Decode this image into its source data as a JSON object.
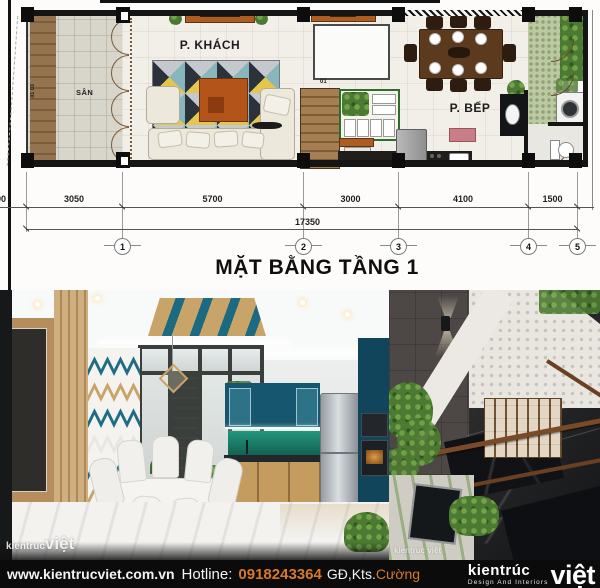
{
  "plan": {
    "title": "MẶT BẰNG TẦNG 1",
    "rooms": {
      "san": "SÂN",
      "khach": "P. KHÁCH",
      "bep": "P. BẾP"
    },
    "tags": {
      "wall_a": "01",
      "wall_b": "03",
      "stair": "01"
    },
    "dimensions": {
      "left_partial": "990",
      "segments": [
        "3050",
        "5700",
        "3000",
        "4100",
        "1500"
      ],
      "total": "17350"
    },
    "grid": [
      "1",
      "2",
      "3",
      "4",
      "5"
    ]
  },
  "footer": {
    "website": "www.kientrucviet.com.vn",
    "hotline_label": "Hotline:",
    "phone": "0918243364",
    "credit_prefix": "GĐ,Kts.",
    "credit_name": "Cường"
  },
  "logo": {
    "word1": "kientrúc",
    "tagline": "Design And Interiors",
    "word2": "việt"
  },
  "watermarks": {
    "small": "kientruc",
    "big": "việt",
    "right": "kientruc việt"
  },
  "colors": {
    "accent_orange": "#d8792a",
    "teal_cabinet": "#16566e",
    "plan_orange": "#ad5d1f"
  }
}
